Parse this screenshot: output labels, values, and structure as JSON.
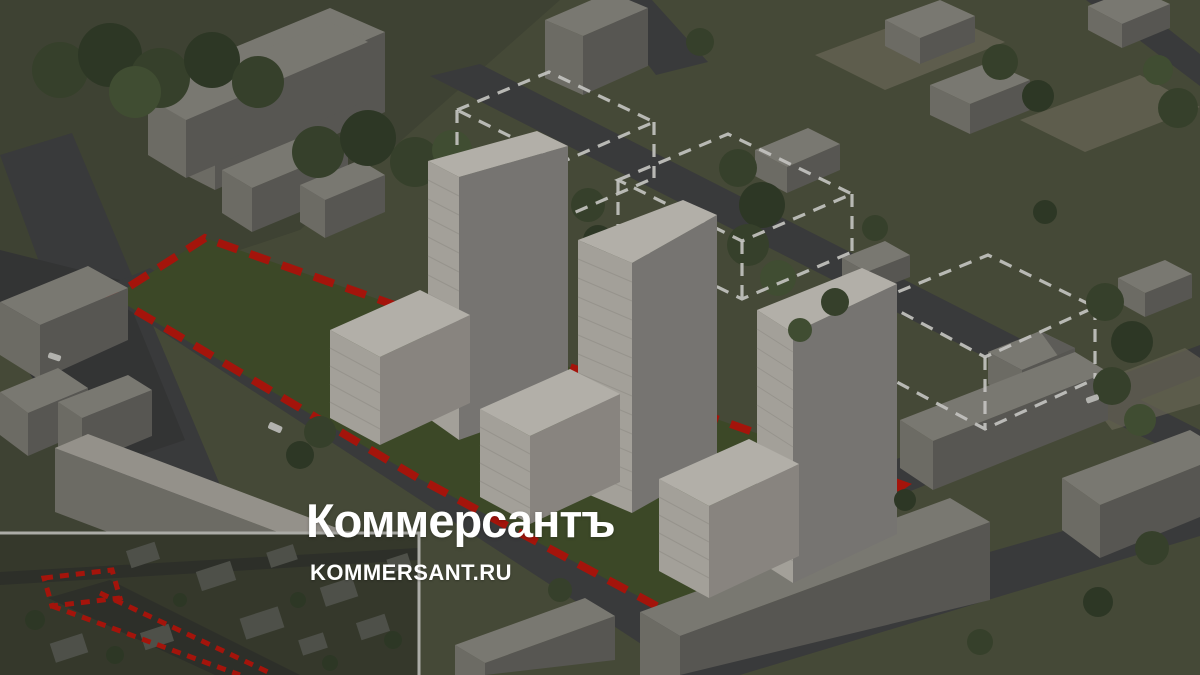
{
  "watermark": {
    "wordmark": "Коммерсантъ",
    "domain": "KOMMERSANT.RU"
  },
  "colors": {
    "grass": "#53584338",
    "grass_base": "#525741",
    "grass_dark": "#494e3c",
    "site_lawn": "#46552e",
    "road": "#434446",
    "road_dark": "#3b3c3e",
    "sand": "#7c7867",
    "bld_top": "#93918a",
    "bld_top_light": "#b4b1a9",
    "bld_front": "#83817a",
    "bld_side": "#686763",
    "tower_top": "#dad6cf",
    "tower_front": "#c7c3bc",
    "tower_side": "#8f8d8a",
    "wing_side": "#a5a19b",
    "tower_line": "#b2aea7",
    "tree": "#3f4c32",
    "tree_dark": "#34402b",
    "tree_light": "#4c5c3b",
    "boundary_red": "#c8150b",
    "outline_white": "#efefec",
    "car_white": "#dadad6",
    "inset_bg": "#3e4233",
    "inset_block": "#5d6058",
    "inset_road": "#343630",
    "inset_border": "#d2d2cd",
    "overlay": "#14150f",
    "logo_white": "#ffffff"
  }
}
